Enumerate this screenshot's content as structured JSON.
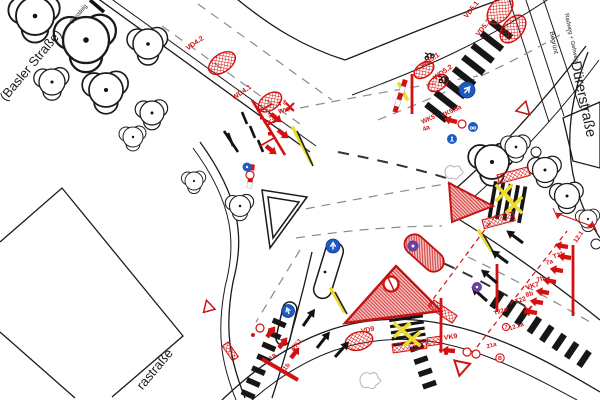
{
  "streets": {
    "basler": "(Basler Straße)",
    "duerer": "Dürerstraße",
    "rastrasse": "rastraße",
    "bussteig": "Bussteig",
    "begruent": "Begrünt",
    "radweg_gehweg": "Radweg + Gehweg"
  },
  "annotations": {
    "vd42": "VD4.2",
    "wd41": "WD4.1",
    "wk4_a": "4 &",
    "wk4": "WK4",
    "vk3_a": "3a",
    "vk3": "VK3",
    "vd51": "VD5.1",
    "vd52": "VD5.2",
    "wd51": "WD5.1",
    "wd52": "WD5.2",
    "vk55a": "VK5.5a",
    "wk5": "WK5",
    "wk5_a": "4a",
    "vd9": "VD9",
    "vk9": "VK9",
    "vk9_n": "9",
    "vk1": "VK1",
    "vk1_a": "1a",
    "vk1_b": "1b",
    "t21": "T21",
    "l7a": "7a",
    "l7b": "7b",
    "vk7": "VK7",
    "l8b": "8b",
    "t22": "T22",
    "t22a": "T22a",
    "l122a": "12.2a",
    "l21a": "21a",
    "l121": "12.1",
    "circled_b": "B",
    "circled_7": "7"
  },
  "colors": {
    "signal_red": "#d41111",
    "hatch_pink": "#f7caca",
    "marking_yellow": "#ecdc2e",
    "sign_blue": "#1d5bc4",
    "sign_purple": "#6a3fa0"
  }
}
